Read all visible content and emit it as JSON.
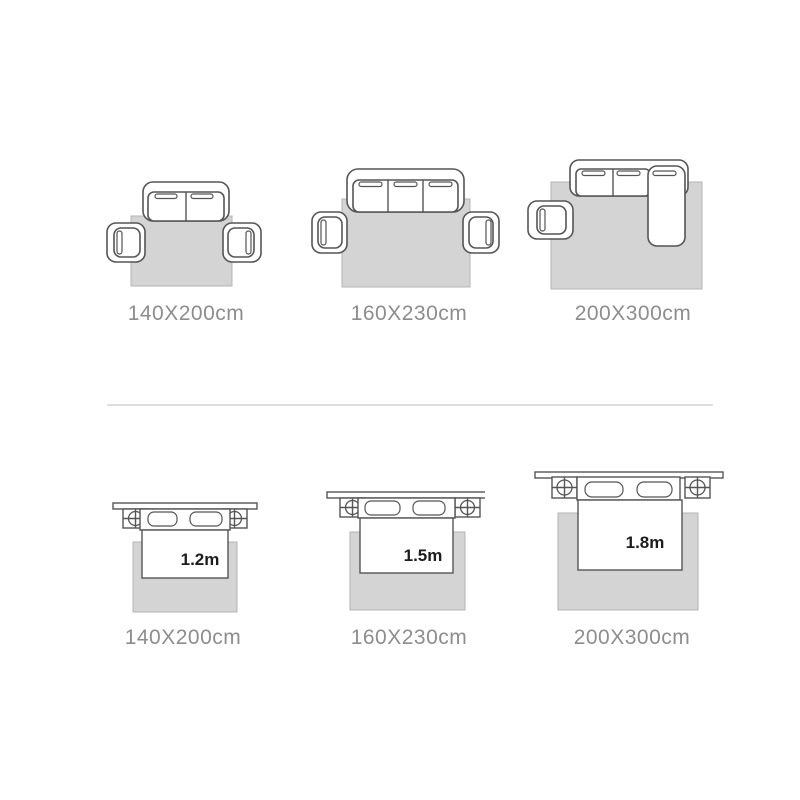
{
  "colors": {
    "background": "#ffffff",
    "outline": "#555555",
    "rug_fill": "#d4d4d4",
    "rug_stroke": "#b5b5b5",
    "caption": "#8d8d8d",
    "size_label": "#1d1d1d",
    "divider": "#dcdcdc"
  },
  "sofa_sizes": {
    "items": [
      {
        "caption": "140X200cm"
      },
      {
        "caption": "160X230cm"
      },
      {
        "caption": "200X300cm"
      }
    ]
  },
  "bed_sizes": {
    "items": [
      {
        "caption": "140X200cm",
        "bed_width": "1.2m"
      },
      {
        "caption": "160X230cm",
        "bed_width": "1.5m"
      },
      {
        "caption": "200X300cm",
        "bed_width": "1.8m"
      }
    ]
  }
}
